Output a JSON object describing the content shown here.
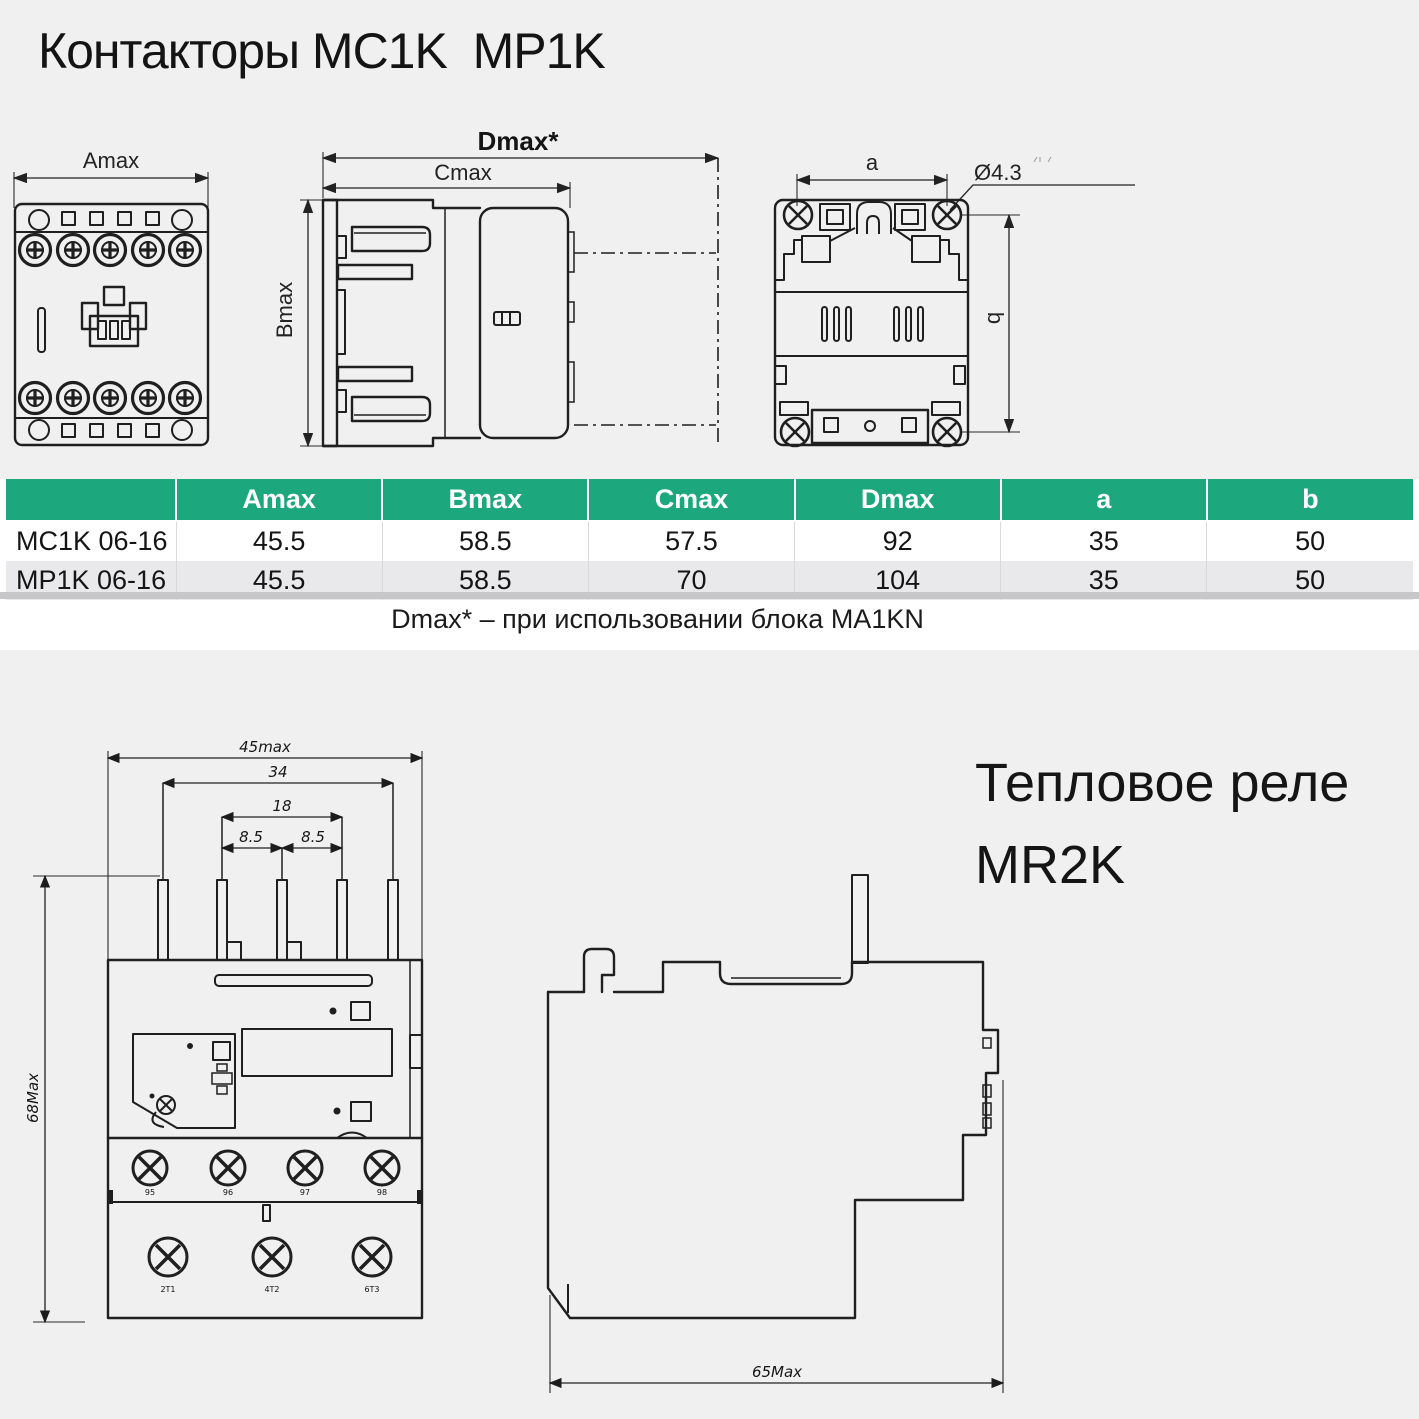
{
  "page": {
    "title": "Контакторы MC1K  MP1K",
    "table_note": "Dmax* – при использовании блока MA1KN",
    "relay_title_line1": "Тепловое реле",
    "relay_title_line2": "MR2K"
  },
  "colors": {
    "header_green": "#1ca87c",
    "alt_row": "#e9e9eb",
    "drawing_background": "#f0f0f1",
    "line_art": "#1f1f1f"
  },
  "table": {
    "headers": [
      "",
      "Amax",
      "Bmax",
      "Cmax",
      "Dmax",
      "a",
      "b"
    ],
    "rows": [
      {
        "name": "MC1K 06-16",
        "values": [
          "45.5",
          "58.5",
          "57.5",
          "92",
          "35",
          "50"
        ]
      },
      {
        "name": "MP1K 06-16",
        "values": [
          "45.5",
          "58.5",
          "70",
          "104",
          "35",
          "50"
        ]
      }
    ]
  },
  "drawings": {
    "contactor_front": {
      "width_dim": "Amax"
    },
    "contactor_side": {
      "total_depth_dim": "Dmax*",
      "depth_dim": "Cmax",
      "height_dim": "Bmax"
    },
    "contactor_rear": {
      "hole_pitch_dim": "a",
      "hole_diameter_dim": "Ø4.3",
      "height_pitch_dim": "b"
    },
    "relay_front": {
      "overall_width_dim": "45max",
      "pin_span_dim": "34",
      "inner_span_dim": "18",
      "pitch_left_dim": "8.5",
      "pitch_right_dim": "8.5",
      "overall_height_dim": "68Max",
      "aux_terminal_labels": [
        "95",
        "96",
        "97",
        "98"
      ],
      "main_terminal_labels": [
        "2T1",
        "4T2",
        "6T3"
      ]
    },
    "relay_side": {
      "overall_depth_dim": "65Max"
    }
  }
}
